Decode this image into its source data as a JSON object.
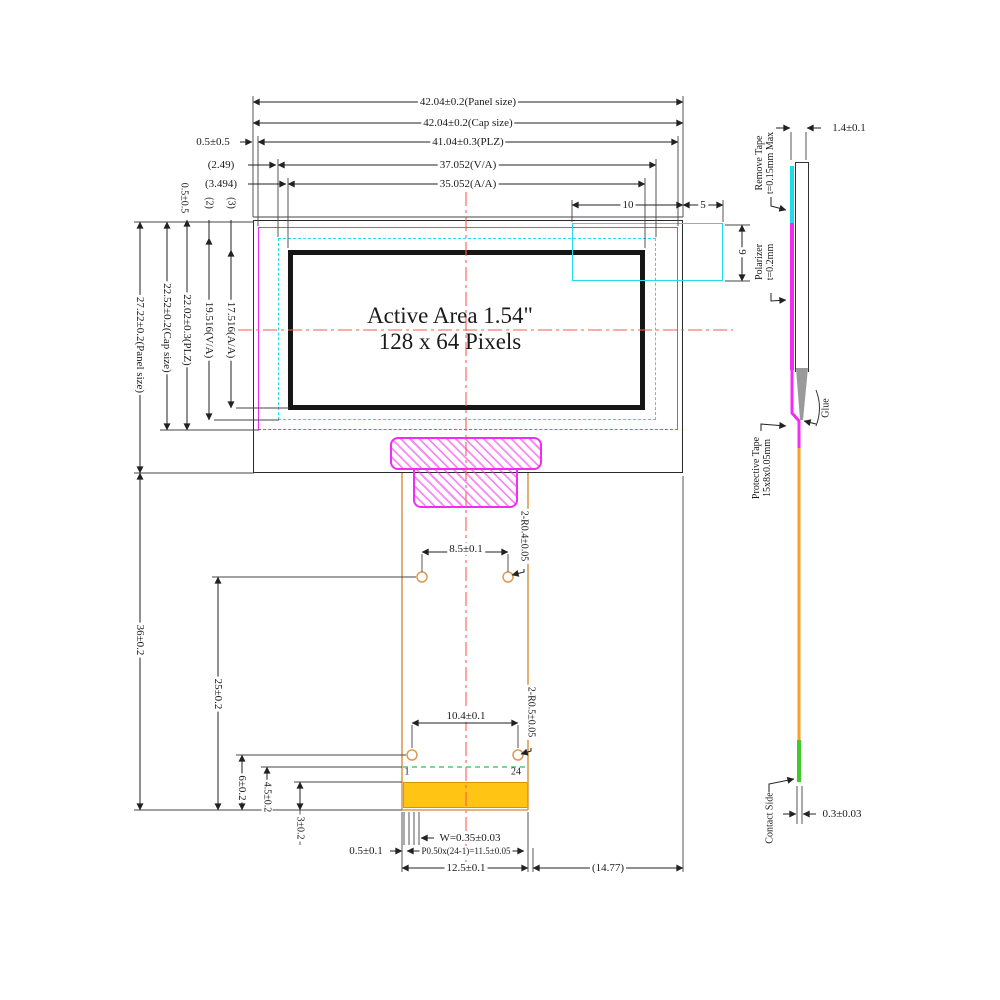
{
  "drawing": {
    "active_area_line1": "Active Area 1.54\"",
    "active_area_line2": "128 x 64 Pixels"
  },
  "top_dims": {
    "panel": "42.04±0.2(Panel size)",
    "cap": "42.04±0.2(Cap size)",
    "plz": "41.04±0.3(PLZ)",
    "va": "37.052(V/A)",
    "aa": "35.052(A/A)",
    "plz_left_gap": "0.5±0.5",
    "va_left_gap": "(2.49)",
    "aa_left_gap": "(3.494)",
    "tape_w_inner": "10",
    "tape_w_outer": "5",
    "tape_h": "9"
  },
  "left_dims": {
    "panel": "27.22±0.2(Panel size)",
    "cap": "22.52±0.2(Cap size)",
    "plz": "22.02±0.3(PLZ)",
    "va": "19.516(V/A)",
    "aa": "17.516(A/A)",
    "plz_top_gap": "0.5±0.5",
    "va_top_gap": "(2)",
    "aa_top_gap": "(3)"
  },
  "fpc_dims": {
    "total_len": "36±0.2",
    "hole_upper_len": "25±0.2",
    "hole_lower_len": "6±0.2",
    "contact_edge": "4.5±0.2",
    "contact_len": "3±0.2",
    "hole_upper_span": "8.5±0.1",
    "hole_lower_span": "10.4±0.1",
    "hole_upper_r": "2-R0.4±0.05",
    "hole_lower_r": "2-R0.5±0.05",
    "pin_first": "1",
    "pin_last": "24",
    "pad_width": "W=0.35±0.03",
    "pad_edge": "0.5±0.1",
    "pad_pitch": "P0.50x(24-1)=11.5±0.05",
    "fpc_width": "12.5±0.1",
    "right_offset": "(14.77)"
  },
  "side_view": {
    "thickness": "1.4±0.1",
    "remove_tape_1": "Remove Tape",
    "remove_tape_2": "t=0.15mm Max",
    "polarizer_1": "Polarizer",
    "polarizer_2": "t=0.2mm",
    "protective_tape_1": "Protective Tape",
    "protective_tape_2": "15x8x0.05mm",
    "glue": "Glue",
    "contact_side": "Contact Side",
    "fpc_thickness": "0.3±0.03"
  },
  "colors": {
    "magenta": "#f42bf4",
    "cyan": "#25dcec",
    "fpc_orange": "#dd9a55",
    "contact_yellow": "#ffc414",
    "contact_green": "#3fcb2a",
    "centerline_red": "#ff5a52"
  }
}
